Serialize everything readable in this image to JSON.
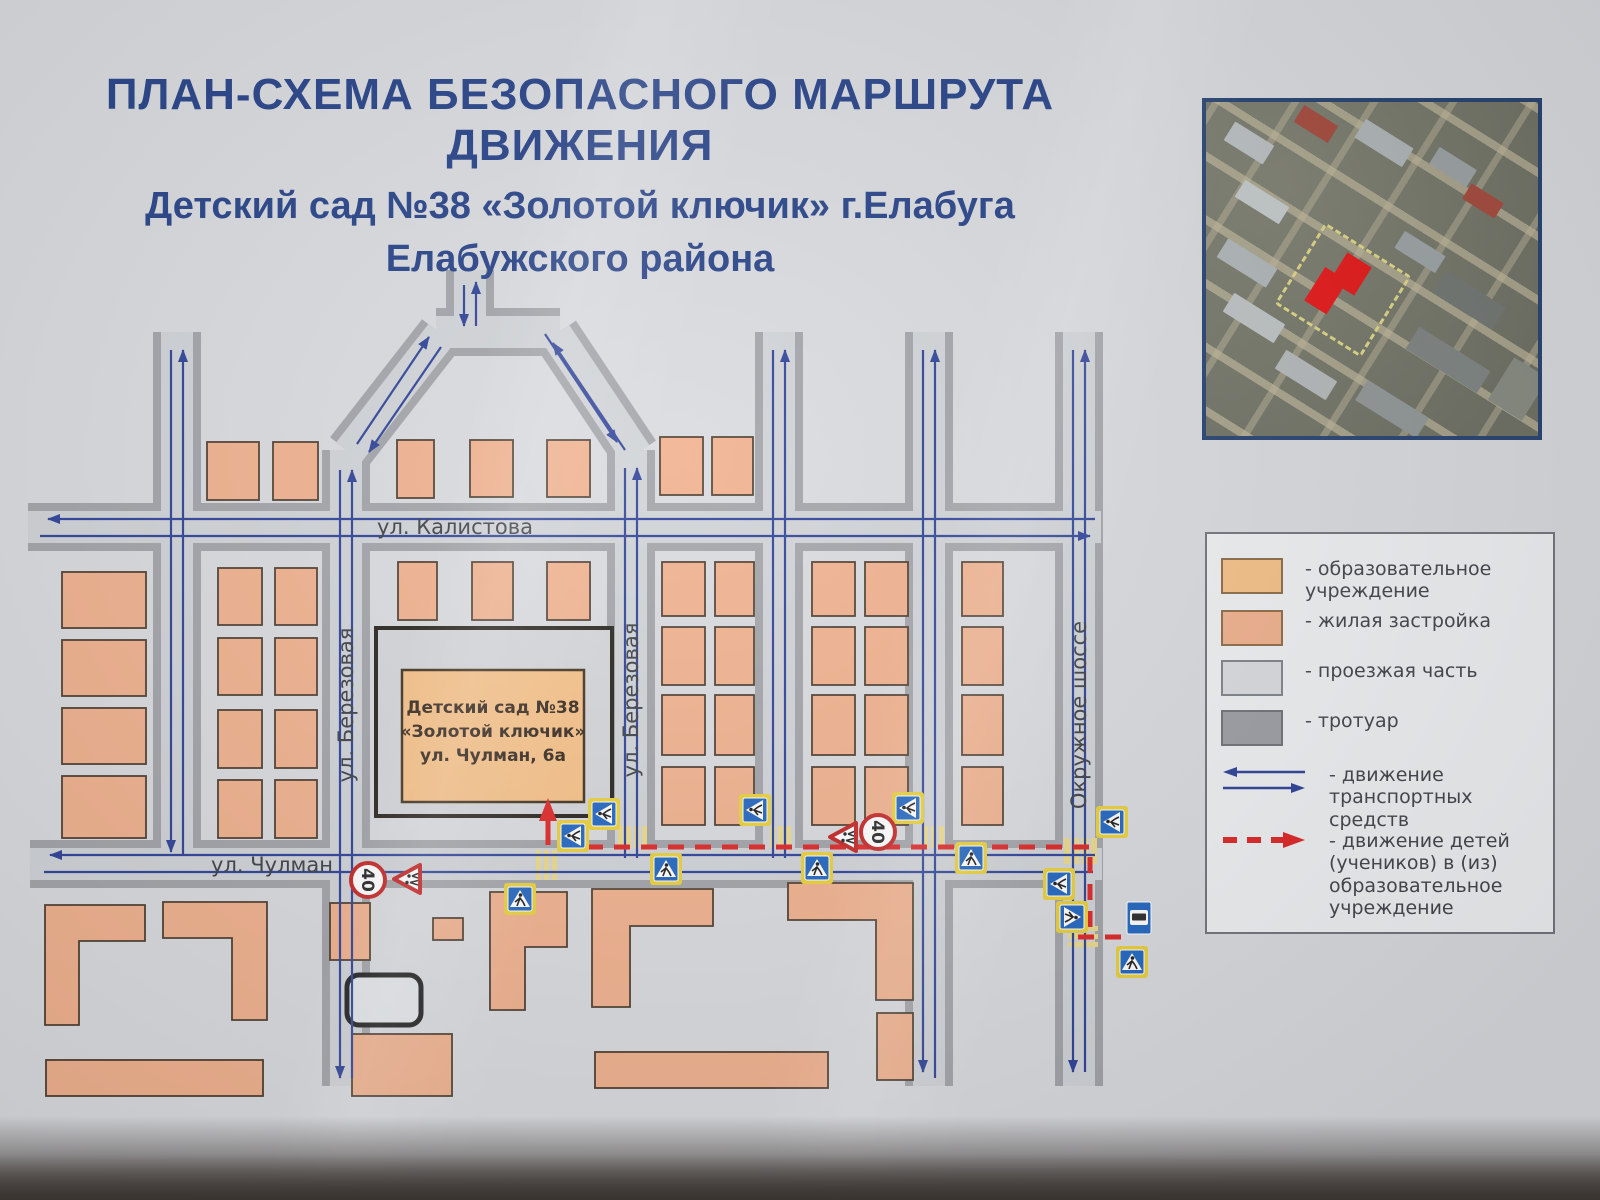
{
  "title": {
    "line1": "ПЛАН-СХЕМА БЕЗОПАСНОГО МАРШРУТА ДВИЖЕНИЯ",
    "line2": "Детский сад №38 «Золотой ключик» г.Елабуга",
    "line3": "Елабужского района"
  },
  "map": {
    "street_labels": {
      "kalistova": "ул. Калистова",
      "chulman": "ул. Чулман",
      "berezovaya_left": "ул. Березовая",
      "berezovaya_right": "ул. Березовая",
      "okruzhnoe_shosse": "Окружное шоссе"
    },
    "kindergarten_label": {
      "line1": "Детский сад №38",
      "line2": "«Золотой ключик»",
      "line3": "ул. Чулман, 6а"
    },
    "speed_limit_sign_value": "40"
  },
  "legend": {
    "items": [
      {
        "label": "- образовательное учреждение"
      },
      {
        "label": "- жилая застройка"
      },
      {
        "label": "- проезжая часть"
      },
      {
        "label": "- тротуар"
      },
      {
        "label": "- движение транспортных средств"
      },
      {
        "label": "- движение детей (учеников) в (из) образовательное учреждение"
      }
    ]
  },
  "colors": {
    "education_building": "#f5bf85",
    "residential_building": "#f0b08c",
    "roadway": "#cfd2d6",
    "sidewalk": "#a0a2a7",
    "traffic_arrow": "#2a3f96",
    "children_route": "#dd2222",
    "title_text": "#223e85"
  }
}
